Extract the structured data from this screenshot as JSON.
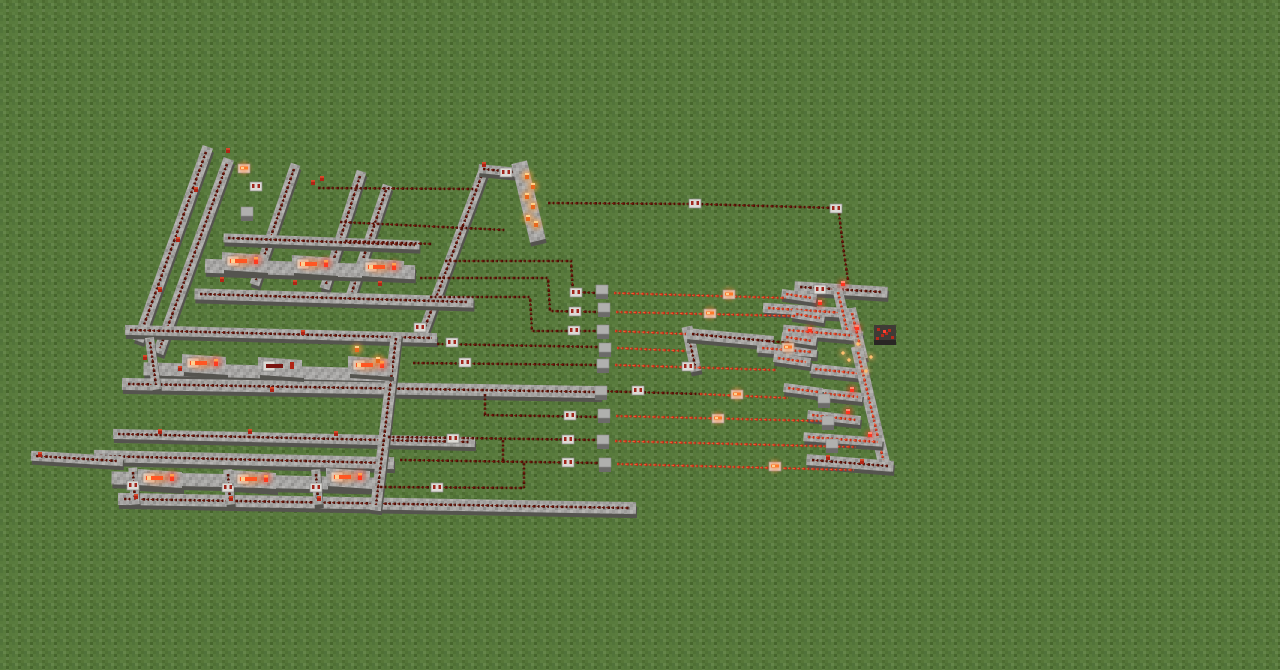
{
  "meta": {
    "game": "Minecraft",
    "scene": "Aerial view of a large redstone logic circuit built on a flat grass plain"
  },
  "palette": {
    "grass": "#587a3c",
    "stone_top": "#a8a7a5",
    "stone_side": "#6b6a68",
    "stone_shadow": "#55544f",
    "wire_off": "#4a0d05",
    "wire_off_hi": "#7c190b",
    "wire_on": "#b72c18",
    "wire_on_hi": "#ff5a30",
    "repeater_body": "#dcdad6",
    "repeater_mark": "#a2261c",
    "torch_red": "#b02415",
    "torch_lit": "#ff9d3a",
    "torch_powered": "#ff3520",
    "glow_orange": "#ff8030",
    "cube_top": "#b0b0ae",
    "cube_side": "#6c6b69",
    "ore_body": "#3f3b36",
    "ore_spot": "#b52a1c"
  },
  "scene": {
    "paths": [
      [
        206,
        152,
        140,
        336,
        11,
        1
      ],
      [
        227,
        164,
        160,
        348,
        11,
        1
      ],
      [
        294,
        169,
        256,
        280,
        10,
        1
      ],
      [
        360,
        176,
        326,
        284,
        10,
        1
      ],
      [
        386,
        190,
        352,
        292,
        10,
        1
      ],
      [
        483,
        172,
        424,
        330,
        10,
        1
      ],
      [
        483,
        169,
        514,
        172,
        9,
        1
      ],
      [
        228,
        238,
        415,
        245,
        9,
        1
      ],
      [
        212,
        266,
        408,
        272,
        14,
        0
      ],
      [
        200,
        294,
        468,
        302,
        11,
        1
      ],
      [
        130,
        330,
        432,
        338,
        10,
        1
      ],
      [
        150,
        369,
        385,
        375,
        13,
        0
      ],
      [
        128,
        384,
        595,
        392,
        12,
        1
      ],
      [
        118,
        434,
        470,
        442,
        10,
        1
      ],
      [
        100,
        456,
        388,
        463,
        12,
        1
      ],
      [
        118,
        478,
        372,
        484,
        13,
        0
      ],
      [
        124,
        499,
        630,
        508,
        12,
        1
      ],
      [
        36,
        456,
        118,
        461,
        10,
        1
      ],
      [
        396,
        338,
        376,
        505,
        11,
        1
      ],
      [
        521,
        170,
        536,
        233,
        16,
        0
      ],
      [
        688,
        332,
        695,
        366,
        11,
        1
      ],
      [
        692,
        334,
        768,
        341,
        11,
        1
      ],
      [
        133,
        472,
        135,
        500,
        9,
        1
      ],
      [
        228,
        474,
        230,
        500,
        9,
        1
      ],
      [
        316,
        474,
        318,
        500,
        9,
        1
      ],
      [
        150,
        342,
        156,
        385,
        9,
        1
      ],
      [
        800,
        287,
        882,
        292,
        11,
        1
      ],
      [
        768,
        308,
        846,
        313,
        10,
        2
      ],
      [
        838,
        292,
        848,
        334,
        10,
        2
      ],
      [
        788,
        330,
        858,
        336,
        10,
        2
      ],
      [
        762,
        348,
        812,
        352,
        10,
        2
      ],
      [
        852,
        313,
        862,
        354,
        10,
        2
      ],
      [
        815,
        369,
        864,
        374,
        10,
        2
      ],
      [
        858,
        352,
        884,
        463,
        12,
        2
      ],
      [
        820,
        393,
        858,
        397,
        9,
        2
      ],
      [
        812,
        415,
        856,
        420,
        9,
        2
      ],
      [
        808,
        437,
        878,
        442,
        9,
        2
      ],
      [
        812,
        460,
        888,
        466,
        11,
        1
      ],
      [
        786,
        294,
        812,
        298,
        9,
        2
      ],
      [
        796,
        314,
        820,
        318,
        9,
        2
      ],
      [
        786,
        337,
        812,
        341,
        9,
        2
      ],
      [
        778,
        358,
        806,
        362,
        9,
        2
      ],
      [
        788,
        388,
        818,
        392,
        9,
        2
      ]
    ],
    "wires": [
      {
        "on": 0,
        "pts": [
          [
            548,
            203
          ],
          [
            695,
            204
          ],
          [
            836,
            208
          ]
        ]
      },
      {
        "on": 0,
        "pts": [
          [
            839,
            213
          ],
          [
            843,
            246
          ],
          [
            848,
            280
          ]
        ]
      },
      {
        "on": 0,
        "pts": [
          [
            318,
            188
          ],
          [
            476,
            189
          ]
        ]
      },
      {
        "on": 0,
        "pts": [
          [
            340,
            222
          ],
          [
            505,
            230
          ]
        ]
      },
      {
        "on": 0,
        "pts": [
          [
            345,
            241
          ],
          [
            432,
            244
          ]
        ]
      },
      {
        "on": 0,
        "pts": [
          [
            445,
            261
          ],
          [
            571,
            261
          ],
          [
            573,
            292
          ],
          [
            598,
            293
          ]
        ]
      },
      {
        "on": 0,
        "pts": [
          [
            420,
            278
          ],
          [
            548,
            278
          ],
          [
            550,
            311
          ],
          [
            600,
            312
          ]
        ]
      },
      {
        "on": 0,
        "pts": [
          [
            430,
            297
          ],
          [
            530,
            297
          ],
          [
            532,
            331
          ],
          [
            600,
            331
          ]
        ]
      },
      {
        "on": 0,
        "pts": [
          [
            437,
            344
          ],
          [
            600,
            347
          ]
        ]
      },
      {
        "on": 0,
        "pts": [
          [
            413,
            363
          ],
          [
            600,
            365
          ]
        ]
      },
      {
        "on": 0,
        "pts": [
          [
            597,
            391
          ],
          [
            700,
            394
          ]
        ]
      },
      {
        "on": 0,
        "pts": [
          [
            485,
            394
          ],
          [
            485,
            415
          ],
          [
            600,
            417
          ]
        ]
      },
      {
        "on": 0,
        "pts": [
          [
            388,
            437
          ],
          [
            600,
            440
          ]
        ]
      },
      {
        "on": 0,
        "pts": [
          [
            503,
            440
          ],
          [
            503,
            463
          ]
        ]
      },
      {
        "on": 0,
        "pts": [
          [
            400,
            460
          ],
          [
            600,
            463
          ]
        ]
      },
      {
        "on": 0,
        "pts": [
          [
            524,
            463
          ],
          [
            524,
            488
          ]
        ]
      },
      {
        "on": 0,
        "pts": [
          [
            380,
            487
          ],
          [
            524,
            488
          ]
        ]
      },
      {
        "on": 0,
        "pts": [
          [
            768,
            341
          ],
          [
            790,
            343
          ]
        ]
      },
      {
        "on": 1,
        "pts": [
          [
            614,
            293
          ],
          [
            786,
            298
          ]
        ]
      },
      {
        "on": 1,
        "pts": [
          [
            616,
            312
          ],
          [
            795,
            316
          ]
        ]
      },
      {
        "on": 1,
        "pts": [
          [
            615,
            331
          ],
          [
            686,
            334
          ]
        ]
      },
      {
        "on": 1,
        "pts": [
          [
            617,
            348
          ],
          [
            686,
            351
          ]
        ]
      },
      {
        "on": 1,
        "pts": [
          [
            615,
            365
          ],
          [
            776,
            370
          ]
        ]
      },
      {
        "on": 1,
        "pts": [
          [
            700,
            394
          ],
          [
            788,
            398
          ]
        ]
      },
      {
        "on": 1,
        "pts": [
          [
            616,
            416
          ],
          [
            822,
            421
          ]
        ]
      },
      {
        "on": 1,
        "pts": [
          [
            615,
            441
          ],
          [
            856,
            447
          ]
        ]
      },
      {
        "on": 1,
        "pts": [
          [
            617,
            464
          ],
          [
            854,
            470
          ]
        ]
      }
    ],
    "cubes": [
      [
        602,
        290
      ],
      [
        604,
        308
      ],
      [
        603,
        330
      ],
      [
        605,
        348
      ],
      [
        603,
        364
      ],
      [
        601,
        391
      ],
      [
        604,
        414
      ],
      [
        603,
        440
      ],
      [
        605,
        463
      ],
      [
        247,
        212
      ],
      [
        824,
        399
      ],
      [
        828,
        421
      ],
      [
        832,
        444
      ]
    ],
    "repeaters": [
      [
        695,
        203,
        0
      ],
      [
        836,
        208,
        0
      ],
      [
        576,
        292,
        0
      ],
      [
        729,
        294,
        1
      ],
      [
        575,
        311,
        0
      ],
      [
        710,
        313,
        1
      ],
      [
        574,
        330,
        0
      ],
      [
        452,
        342,
        0
      ],
      [
        465,
        362,
        0
      ],
      [
        688,
        366,
        0
      ],
      [
        638,
        390,
        0
      ],
      [
        737,
        394,
        1
      ],
      [
        570,
        415,
        0
      ],
      [
        718,
        418,
        1
      ],
      [
        453,
        438,
        0
      ],
      [
        568,
        439,
        0
      ],
      [
        568,
        462,
        0
      ],
      [
        775,
        466,
        1
      ],
      [
        437,
        487,
        0
      ],
      [
        420,
        327,
        0
      ],
      [
        256,
        186,
        0
      ],
      [
        244,
        168,
        1
      ],
      [
        133,
        485,
        0
      ],
      [
        228,
        487,
        0
      ],
      [
        316,
        487,
        0
      ],
      [
        820,
        289,
        0
      ],
      [
        788,
        347,
        1
      ],
      [
        506,
        172,
        0
      ]
    ],
    "units": [
      [
        222,
        248,
        1
      ],
      [
        292,
        251,
        1
      ],
      [
        360,
        254,
        1
      ],
      [
        182,
        350,
        1
      ],
      [
        258,
        353,
        0
      ],
      [
        348,
        352,
        1
      ],
      [
        138,
        465,
        1
      ],
      [
        232,
        466,
        1
      ],
      [
        326,
        464,
        1
      ]
    ],
    "torches": [
      [
        228,
        151,
        "r"
      ],
      [
        313,
        183,
        "r"
      ],
      [
        322,
        179,
        "r"
      ],
      [
        484,
        165,
        "r"
      ],
      [
        196,
        190,
        "r"
      ],
      [
        178,
        240,
        "r"
      ],
      [
        160,
        290,
        "r"
      ],
      [
        222,
        280,
        "r"
      ],
      [
        295,
        283,
        "r"
      ],
      [
        380,
        284,
        "r"
      ],
      [
        527,
        176,
        "l"
      ],
      [
        533,
        186,
        "l"
      ],
      [
        527,
        196,
        "l"
      ],
      [
        533,
        206,
        "l"
      ],
      [
        528,
        218,
        "l"
      ],
      [
        536,
        224,
        "l"
      ],
      [
        180,
        369,
        "r"
      ],
      [
        303,
        333,
        "r"
      ],
      [
        145,
        358,
        "r"
      ],
      [
        357,
        349,
        "l"
      ],
      [
        378,
        360,
        "l"
      ],
      [
        272,
        390,
        "r"
      ],
      [
        160,
        432,
        "r"
      ],
      [
        250,
        432,
        "r"
      ],
      [
        336,
        434,
        "r"
      ],
      [
        40,
        455,
        "r"
      ],
      [
        136,
        497,
        "r"
      ],
      [
        231,
        499,
        "r"
      ],
      [
        319,
        499,
        "r"
      ],
      [
        843,
        284,
        "p"
      ],
      [
        820,
        303,
        "p"
      ],
      [
        810,
        330,
        "p"
      ],
      [
        857,
        328,
        "p"
      ],
      [
        852,
        390,
        "p"
      ],
      [
        848,
        412,
        "p"
      ],
      [
        870,
        435,
        "p"
      ],
      [
        828,
        458,
        "r"
      ],
      [
        862,
        462,
        "r"
      ]
    ],
    "ore": {
      "x": 884,
      "y": 334
    },
    "particles": [
      [
        858,
        344
      ],
      [
        849,
        360
      ],
      [
        866,
        371
      ],
      [
        843,
        353
      ],
      [
        871,
        357
      ]
    ]
  }
}
